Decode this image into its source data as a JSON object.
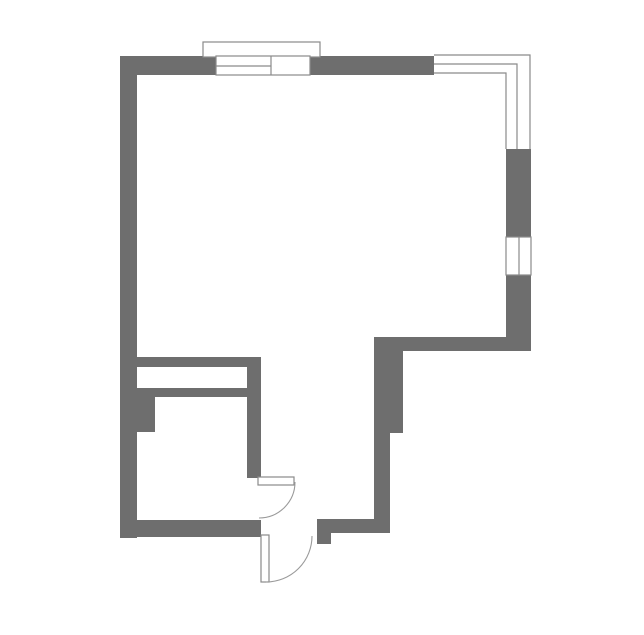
{
  "canvas": {
    "width": 644,
    "height": 635,
    "background": "#ffffff"
  },
  "colors": {
    "wall": "#6e6e6e",
    "outline": "#8a8a8a",
    "swing": "#9a9a9a",
    "window_fill": "#ffffff"
  },
  "floorplan": {
    "white_polygons": [
      {
        "name": "corner-window-backing",
        "points": "434,55 531,55 531,149 506,149 506,75 434,75"
      }
    ],
    "walls": [
      {
        "name": "wall-top",
        "x": 120,
        "y": 56,
        "w": 314,
        "h": 19
      },
      {
        "name": "wall-left",
        "x": 120,
        "y": 56,
        "w": 17,
        "h": 482
      },
      {
        "name": "wall-right-upper",
        "x": 506,
        "y": 149,
        "w": 25,
        "h": 88
      },
      {
        "name": "wall-right-lower",
        "x": 506,
        "y": 275,
        "w": 25,
        "h": 76
      },
      {
        "name": "wall-step-horizontal",
        "x": 374,
        "y": 337,
        "w": 157,
        "h": 14
      },
      {
        "name": "wall-step-vertical-upper",
        "x": 374,
        "y": 337,
        "w": 29,
        "h": 96
      },
      {
        "name": "wall-step-vertical-lower",
        "x": 374,
        "y": 433,
        "w": 16,
        "h": 97
      },
      {
        "name": "wall-bottom-right",
        "x": 317,
        "y": 519,
        "w": 73,
        "h": 14
      },
      {
        "name": "door-stop-tab",
        "x": 317,
        "y": 533,
        "w": 14,
        "h": 11
      },
      {
        "name": "wall-bottom-left",
        "x": 120,
        "y": 520,
        "w": 141,
        "h": 17
      },
      {
        "name": "shaft-top-band",
        "x": 137,
        "y": 357,
        "w": 121,
        "h": 10
      },
      {
        "name": "shaft-right-wall",
        "x": 247,
        "y": 357,
        "w": 14,
        "h": 121
      },
      {
        "name": "shaft-bottom-band",
        "x": 137,
        "y": 388,
        "w": 110,
        "h": 9
      },
      {
        "name": "wall-pier",
        "x": 137,
        "y": 397,
        "w": 18,
        "h": 35
      }
    ],
    "outlined_rects": [
      {
        "name": "window-top-sill",
        "x": 203,
        "y": 42,
        "w": 117,
        "h": 15
      },
      {
        "name": "window-top-opening",
        "x": 216,
        "y": 56,
        "w": 94,
        "h": 19
      },
      {
        "name": "window-right-opening",
        "x": 506,
        "y": 237,
        "w": 25,
        "h": 38
      },
      {
        "name": "door-interior-leaf",
        "x": 258,
        "y": 477,
        "w": 36,
        "h": 8
      },
      {
        "name": "door-exterior-leaf",
        "x": 261,
        "y": 535,
        "w": 8,
        "h": 47
      }
    ],
    "window_lines": [
      {
        "name": "window-top-divider",
        "d": "M 271 56 L 271 75"
      },
      {
        "name": "window-top-mullion",
        "d": "M 216 66 L 271 66"
      },
      {
        "name": "window-right-mullion",
        "d": "M 519 237 L 519 275"
      },
      {
        "name": "corner-window-outer-line",
        "d": "M 434 55 L 530 55 L 530 149"
      },
      {
        "name": "corner-window-middle-line",
        "d": "M 434 64 L 517 64 L 517 149"
      },
      {
        "name": "corner-window-inner-line",
        "d": "M 434 73 L 506 73 L 506 149"
      }
    ],
    "door_swings": [
      {
        "name": "door-interior-swing",
        "d": "M 295 482 A 36 36 0 0 1 259 518"
      },
      {
        "name": "door-exterior-swing",
        "d": "M 266 582 A 46 46 0 0 0 312 536"
      }
    ]
  }
}
